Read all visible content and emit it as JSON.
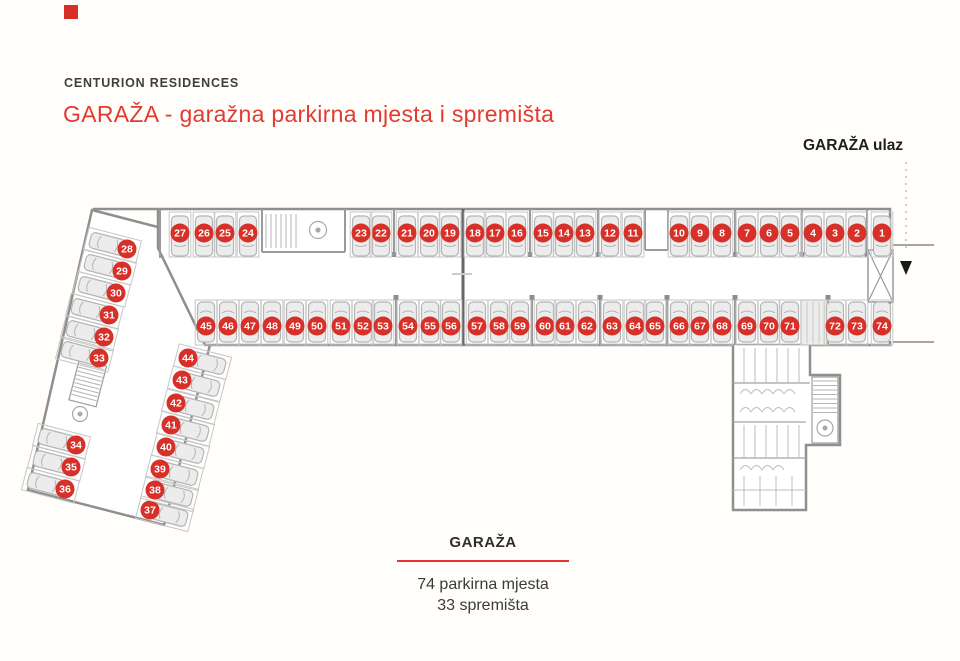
{
  "header": {
    "brand": "CENTURION RESIDENCES",
    "title": "GARAŽA - garažna parkirna mjesta i spremišta"
  },
  "plan": {
    "entrance_label": "GARAŽA ulaz",
    "wing_rotation_deg": 14.5,
    "spots": [
      {
        "n": 1,
        "x": 882,
        "y": 233,
        "row": "top"
      },
      {
        "n": 2,
        "x": 857,
        "y": 233,
        "row": "top"
      },
      {
        "n": 3,
        "x": 835,
        "y": 233,
        "row": "top"
      },
      {
        "n": 4,
        "x": 813,
        "y": 233,
        "row": "top"
      },
      {
        "n": 5,
        "x": 790,
        "y": 233,
        "row": "top"
      },
      {
        "n": 6,
        "x": 769,
        "y": 233,
        "row": "top"
      },
      {
        "n": 7,
        "x": 747,
        "y": 233,
        "row": "top"
      },
      {
        "n": 8,
        "x": 722,
        "y": 233,
        "row": "top"
      },
      {
        "n": 9,
        "x": 700,
        "y": 233,
        "row": "top"
      },
      {
        "n": 10,
        "x": 679,
        "y": 233,
        "row": "top"
      },
      {
        "n": 11,
        "x": 633,
        "y": 233,
        "row": "top"
      },
      {
        "n": 12,
        "x": 610,
        "y": 233,
        "row": "top"
      },
      {
        "n": 13,
        "x": 585,
        "y": 233,
        "row": "top"
      },
      {
        "n": 14,
        "x": 564,
        "y": 233,
        "row": "top"
      },
      {
        "n": 15,
        "x": 543,
        "y": 233,
        "row": "top"
      },
      {
        "n": 16,
        "x": 517,
        "y": 233,
        "row": "top"
      },
      {
        "n": 17,
        "x": 495,
        "y": 233,
        "row": "top"
      },
      {
        "n": 18,
        "x": 475,
        "y": 233,
        "row": "top"
      },
      {
        "n": 19,
        "x": 450,
        "y": 233,
        "row": "top"
      },
      {
        "n": 20,
        "x": 429,
        "y": 233,
        "row": "top"
      },
      {
        "n": 21,
        "x": 407,
        "y": 233,
        "row": "top"
      },
      {
        "n": 22,
        "x": 381,
        "y": 233,
        "row": "top"
      },
      {
        "n": 23,
        "x": 361,
        "y": 233,
        "row": "top"
      },
      {
        "n": 24,
        "x": 248,
        "y": 233,
        "row": "top"
      },
      {
        "n": 25,
        "x": 225,
        "y": 233,
        "row": "top"
      },
      {
        "n": 26,
        "x": 204,
        "y": 233,
        "row": "top"
      },
      {
        "n": 27,
        "x": 180,
        "y": 233,
        "row": "top"
      },
      {
        "n": 28,
        "x": 127,
        "y": 249,
        "row": "wing-left"
      },
      {
        "n": 29,
        "x": 122,
        "y": 271,
        "row": "wing-left"
      },
      {
        "n": 30,
        "x": 116,
        "y": 293,
        "row": "wing-left"
      },
      {
        "n": 31,
        "x": 109,
        "y": 315,
        "row": "wing-left"
      },
      {
        "n": 32,
        "x": 104,
        "y": 337,
        "row": "wing-left"
      },
      {
        "n": 33,
        "x": 99,
        "y": 358,
        "row": "wing-left"
      },
      {
        "n": 34,
        "x": 76,
        "y": 445,
        "row": "wing-left"
      },
      {
        "n": 35,
        "x": 71,
        "y": 467,
        "row": "wing-left"
      },
      {
        "n": 36,
        "x": 65,
        "y": 489,
        "row": "wing-left"
      },
      {
        "n": 37,
        "x": 150,
        "y": 510,
        "row": "wing-right"
      },
      {
        "n": 38,
        "x": 155,
        "y": 490,
        "row": "wing-right"
      },
      {
        "n": 39,
        "x": 160,
        "y": 469,
        "row": "wing-right"
      },
      {
        "n": 40,
        "x": 166,
        "y": 447,
        "row": "wing-right"
      },
      {
        "n": 41,
        "x": 171,
        "y": 425,
        "row": "wing-right"
      },
      {
        "n": 42,
        "x": 176,
        "y": 403,
        "row": "wing-right"
      },
      {
        "n": 43,
        "x": 182,
        "y": 380,
        "row": "wing-right"
      },
      {
        "n": 44,
        "x": 188,
        "y": 358,
        "row": "wing-right"
      },
      {
        "n": 45,
        "x": 206,
        "y": 326,
        "row": "bottom"
      },
      {
        "n": 46,
        "x": 228,
        "y": 326,
        "row": "bottom"
      },
      {
        "n": 47,
        "x": 250,
        "y": 326,
        "row": "bottom"
      },
      {
        "n": 48,
        "x": 272,
        "y": 326,
        "row": "bottom"
      },
      {
        "n": 49,
        "x": 295,
        "y": 326,
        "row": "bottom"
      },
      {
        "n": 50,
        "x": 317,
        "y": 326,
        "row": "bottom"
      },
      {
        "n": 51,
        "x": 341,
        "y": 326,
        "row": "bottom"
      },
      {
        "n": 52,
        "x": 363,
        "y": 326,
        "row": "bottom"
      },
      {
        "n": 53,
        "x": 383,
        "y": 326,
        "row": "bottom"
      },
      {
        "n": 54,
        "x": 408,
        "y": 326,
        "row": "bottom"
      },
      {
        "n": 55,
        "x": 430,
        "y": 326,
        "row": "bottom"
      },
      {
        "n": 56,
        "x": 451,
        "y": 326,
        "row": "bottom"
      },
      {
        "n": 57,
        "x": 477,
        "y": 326,
        "row": "bottom"
      },
      {
        "n": 58,
        "x": 499,
        "y": 326,
        "row": "bottom"
      },
      {
        "n": 59,
        "x": 520,
        "y": 326,
        "row": "bottom"
      },
      {
        "n": 60,
        "x": 545,
        "y": 326,
        "row": "bottom"
      },
      {
        "n": 61,
        "x": 565,
        "y": 326,
        "row": "bottom"
      },
      {
        "n": 62,
        "x": 587,
        "y": 326,
        "row": "bottom"
      },
      {
        "n": 63,
        "x": 612,
        "y": 326,
        "row": "bottom"
      },
      {
        "n": 64,
        "x": 635,
        "y": 326,
        "row": "bottom"
      },
      {
        "n": 65,
        "x": 655,
        "y": 326,
        "row": "bottom"
      },
      {
        "n": 66,
        "x": 679,
        "y": 326,
        "row": "bottom"
      },
      {
        "n": 67,
        "x": 700,
        "y": 326,
        "row": "bottom"
      },
      {
        "n": 68,
        "x": 722,
        "y": 326,
        "row": "bottom"
      },
      {
        "n": 69,
        "x": 747,
        "y": 326,
        "row": "bottom"
      },
      {
        "n": 70,
        "x": 769,
        "y": 326,
        "row": "bottom"
      },
      {
        "n": 71,
        "x": 790,
        "y": 326,
        "row": "bottom"
      },
      {
        "n": 72,
        "x": 835,
        "y": 326,
        "row": "bottom"
      },
      {
        "n": 73,
        "x": 857,
        "y": 326,
        "row": "bottom"
      },
      {
        "n": 74,
        "x": 882,
        "y": 326,
        "row": "bottom"
      }
    ]
  },
  "legend": {
    "title": "GARAŽA",
    "line1": "74 parkirna mjesta",
    "line2": "33 spremišta"
  },
  "colors": {
    "accent": "#d63029",
    "title_red": "#e23a31",
    "wall": "#8f8f8f",
    "wall_dark": "#666666",
    "stall": "#c6c6c6",
    "car_fill": "#ececec",
    "car_stroke": "#b5b5b5"
  }
}
